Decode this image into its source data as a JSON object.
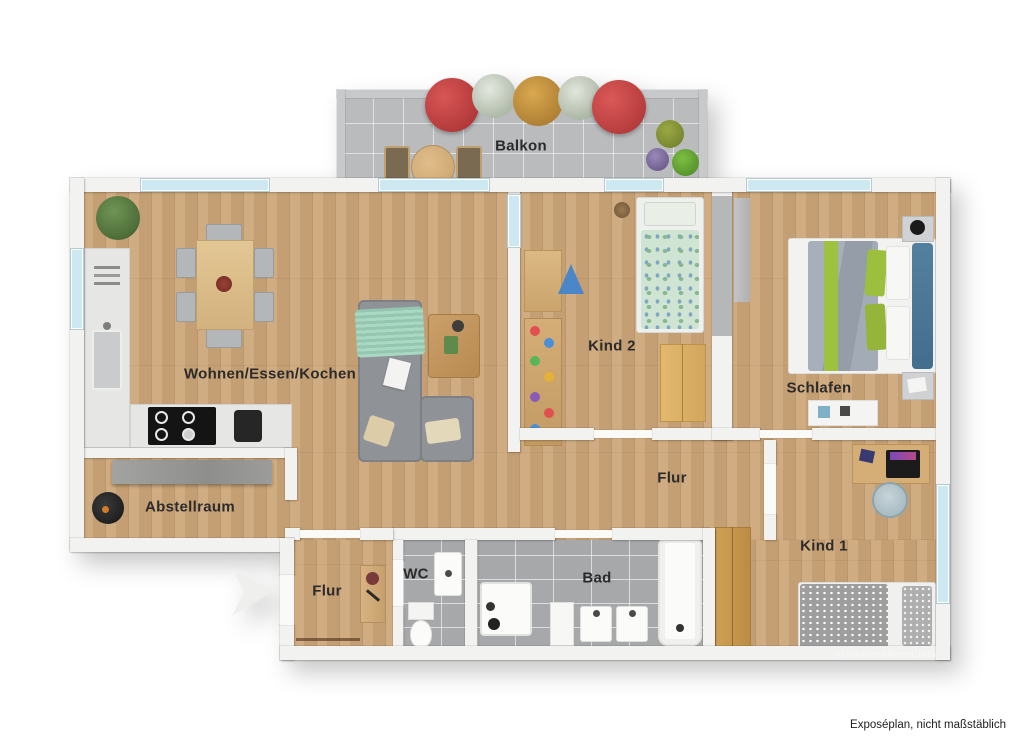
{
  "rooms": {
    "balkon": {
      "label": "Balkon"
    },
    "wohnen": {
      "label": "Wohnen/Essen/Kochen"
    },
    "kind2": {
      "label": "Kind 2"
    },
    "schlafen": {
      "label": "Schlafen"
    },
    "flur_mitte": {
      "label": "Flur"
    },
    "abstellraum": {
      "label": "Abstellraum"
    },
    "flur_eingang": {
      "label": "Flur"
    },
    "wc": {
      "label": "WC"
    },
    "bad": {
      "label": "Bad"
    },
    "kind1": {
      "label": "Kind 1"
    }
  },
  "annotations": {
    "watermark": "Illustration©ImmoGrafix",
    "footer_note": "Exposéplan, nicht maßstäblich"
  },
  "colors": {
    "wood_floor": "#cda678",
    "balcony_tile": "#b9bbbd",
    "bath_tile": "#a6a8aa",
    "wall": "#f2f2f0",
    "window_glass": "#cde8f0",
    "accent_green": "#9cbf3e",
    "accent_blue": "#4f7ca3",
    "sofa_gray": "#8f9296"
  }
}
